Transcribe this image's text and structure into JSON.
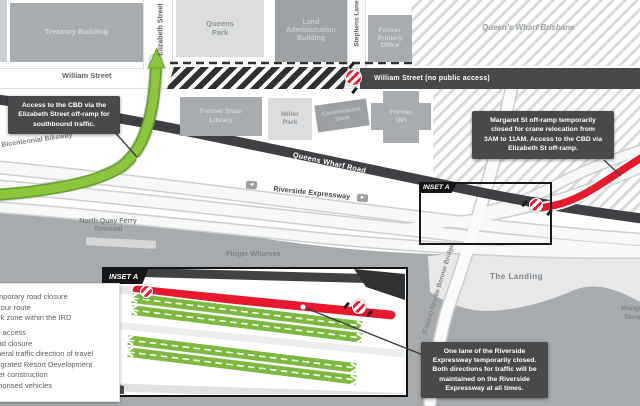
{
  "streets": {
    "william": "William Street",
    "william_closed": "William Street (no public access)",
    "elizabeth": "Elizabeth Street",
    "stephens_lane": "Stephens Lane",
    "queens_wharf_road": "Queens Wharf Road",
    "riverside_expressway": "Riverside Expressway",
    "bicentennial_bikeway": "Bicentennial Bikeway",
    "neville_bonner_bridge": "(Future) Neville Bonner Bridge"
  },
  "places": {
    "treasury_building": "Treasury Building",
    "queens_park": "Queens Park",
    "land_administration_building": "Land Administration Building",
    "former_printery_office": "Former Printery Office",
    "queens_wharf_brisbane": "Queen's Wharf Brisbane",
    "former_state_library": "Former State Library",
    "miller_park": "Miller Park",
    "commissariat_store": "Commissariat Store",
    "former_dpi": "Former DPI",
    "north_quay_ferry_terminal": "North Quay Ferry Terminal",
    "finger_wharves": "Finger Wharves",
    "the_landing": "The Landing",
    "mangrove_line1": "Mangrove",
    "mangrove_line2": "Terrace"
  },
  "inset": {
    "map_label": "INSET A",
    "box_label": "INSET A"
  },
  "callouts": {
    "access_cbd": {
      "lines": [
        "Access to the CBD via the",
        "Elizabeth Street off-ramp for",
        "southbound traffic."
      ]
    },
    "margaret_st": {
      "lines": [
        "Margaret St off-ramp temporarily",
        "closed for crane relocation from",
        "3AM to 11AM. Access to the CBD via",
        "Elizabeth St off-ramp."
      ]
    },
    "one_lane": {
      "lines": [
        "One lane of the Riverside",
        "Expressway temporarily closed.",
        "Both directions for traffic will be",
        "maintained on the Riverside",
        "Expressway at all times."
      ]
    }
  },
  "legend": {
    "items": [
      "Temporary road closure",
      "Detour route",
      "Work zone within the IRD",
      "No access",
      "Road closure",
      "General traffic direction of travel",
      "Integrated Resort Development",
      "under construction",
      "Authorised vehicles"
    ]
  },
  "icons": {
    "dir_left": "◄",
    "dir_right": "►"
  },
  "colors": {
    "detour_green": "#8CC63F",
    "closure_red": "#E9192D",
    "callout_dark": "#47494B",
    "road_dark": "#3E4043"
  }
}
